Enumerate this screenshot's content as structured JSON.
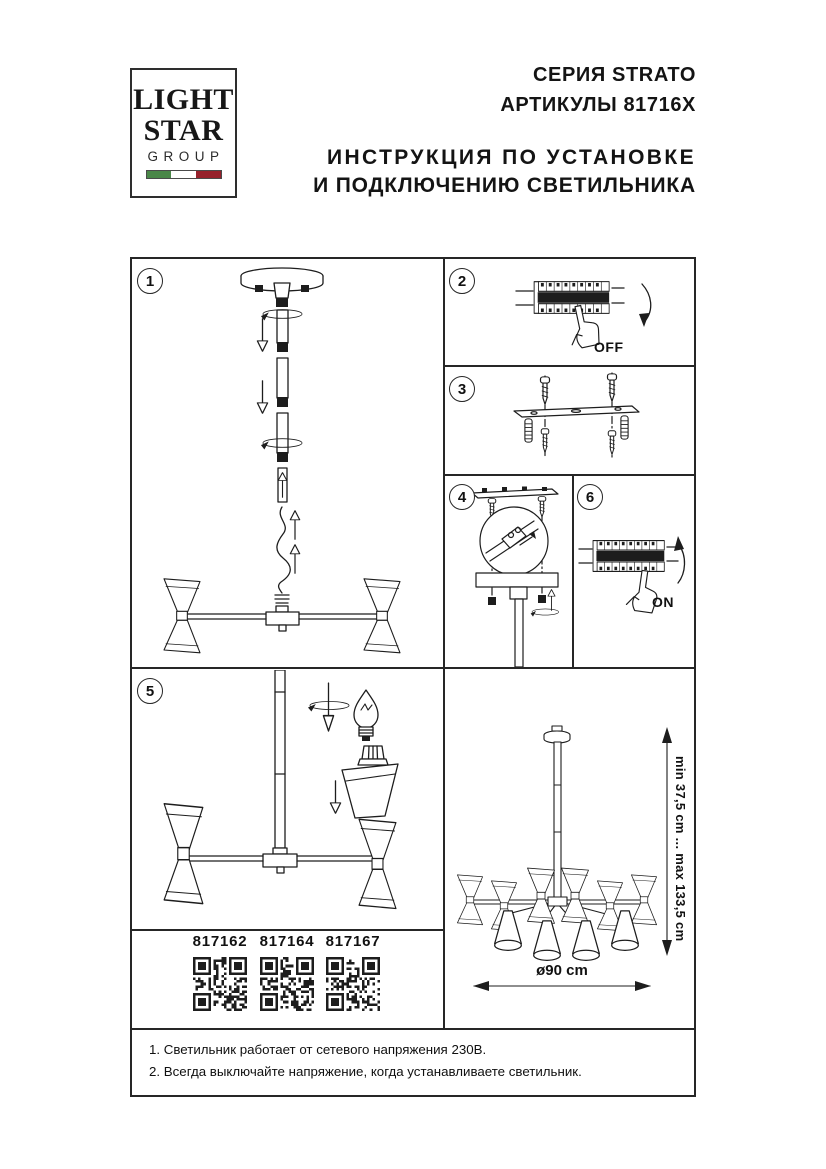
{
  "header": {
    "logo": {
      "line1": "LIGHT",
      "line2": "STAR",
      "line3": "GROUP"
    },
    "series": "СЕРИЯ STRATO",
    "articles": "АРТИКУЛЫ 81716X",
    "instruction_line1": "ИНСТРУКЦИЯ ПО УСТАНОВКЕ",
    "instruction_line2": "И ПОДКЛЮЧЕНИЮ СВЕТИЛЬНИКА"
  },
  "colors": {
    "ink": "#1d1d1d",
    "paper": "#ffffff",
    "flag_green": "#4a8748",
    "flag_red": "#96212b"
  },
  "steps": {
    "step1": {
      "number": "1"
    },
    "step2": {
      "number": "2",
      "label": "OFF"
    },
    "step3": {
      "number": "3"
    },
    "step4": {
      "number": "4"
    },
    "step5": {
      "number": "5"
    },
    "step6": {
      "number": "6",
      "label": "ON"
    }
  },
  "qr_section": {
    "articles": [
      {
        "code": "817162"
      },
      {
        "code": "817164"
      },
      {
        "code": "817167"
      }
    ]
  },
  "dimensions": {
    "height_range": "min 37,5 cm ... max 133,5 cm",
    "diameter": "ø90 cm"
  },
  "notes": {
    "line1": "1. Светильник работает от сетевого напряжения 230В.",
    "line2": "2. Всегда выключайте напряжение, когда устанавливаете светильник."
  }
}
